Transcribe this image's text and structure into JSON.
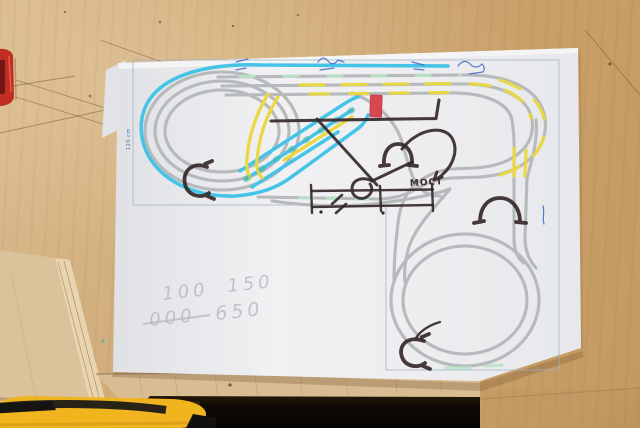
{
  "photo": {
    "bridge_label": "МОСТ",
    "dimension_label": "120 cm",
    "pencil_row1_a": "100",
    "pencil_row1_b": "150",
    "pencil_row2_a": "000",
    "pencil_row2_b": "650"
  },
  "colors": {
    "wood": "#cfa977",
    "paper": "#ededf0",
    "track_gray": "#b7babc",
    "track_cyan": "#45c4e7",
    "track_yellow": "#e9d83f",
    "track_green": "#3fae9b",
    "green_segment": "#b9e4c6",
    "marker_black": "#35282b",
    "red_marker": "#d8474f",
    "knife_yellow": "#f0b41f",
    "tool_red": "#c12d22",
    "pen_blue": "#3c63c8",
    "pencil_gray": "#bdb8c4",
    "border_blue": "#9db0c6",
    "dim_blue": "#4a6fa5"
  }
}
